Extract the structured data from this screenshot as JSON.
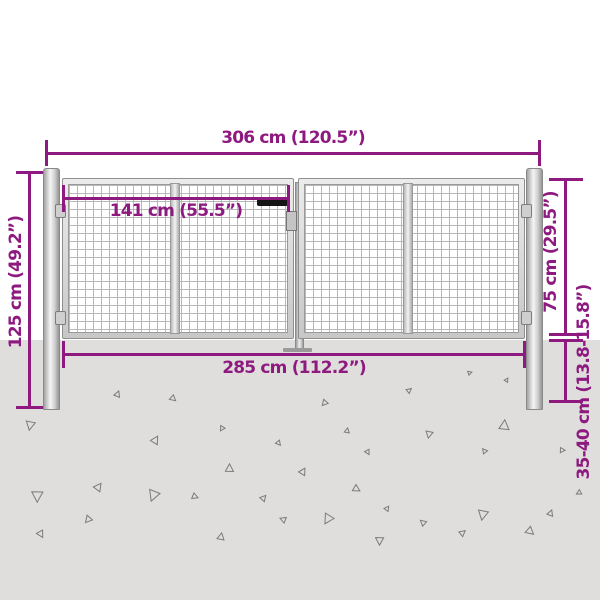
{
  "diagram": {
    "title": "garden-gate-dimension-diagram",
    "dimensions": {
      "total_width": "306 cm (120.5”)",
      "leaf_width": "141 cm (55.5”)",
      "inner_width": "285 cm (112.2”)",
      "post_height": "125 cm (49.2”)",
      "gate_height": "75 cm (29.5”)",
      "ground_depth": "35-40 cm (13.8-15.8”)"
    },
    "colors": {
      "dimension_accent": "#8E1A80",
      "ground": "#DFDEDC",
      "metal_light": "#F5F5F5",
      "metal_dark": "#969696",
      "mesh_line": "#B8B8B8",
      "triangle_stroke": "#7B7B7B",
      "background": "#FFFFFF",
      "handle": "#151515"
    },
    "ground_triangles": [
      [
        25,
        421,
        9,
        200
      ],
      [
        115,
        391,
        6,
        30
      ],
      [
        170,
        396,
        6,
        140
      ],
      [
        152,
        436,
        8,
        40
      ],
      [
        219,
        426,
        5,
        220
      ],
      [
        226,
        464,
        8,
        10
      ],
      [
        276,
        441,
        5,
        150
      ],
      [
        300,
        468,
        7,
        40
      ],
      [
        321,
        400,
        6,
        230
      ],
      [
        345,
        428,
        5,
        20
      ],
      [
        365,
        450,
        5,
        160
      ],
      [
        407,
        388,
        5,
        60
      ],
      [
        425,
        431,
        7,
        200
      ],
      [
        482,
        448,
        5,
        330
      ],
      [
        500,
        420,
        10,
        15
      ],
      [
        31,
        491,
        11,
        190
      ],
      [
        95,
        483,
        8,
        45
      ],
      [
        147,
        490,
        11,
        210
      ],
      [
        192,
        494,
        6,
        120
      ],
      [
        261,
        495,
        6,
        50
      ],
      [
        84,
        516,
        7,
        230
      ],
      [
        37,
        531,
        7,
        160
      ],
      [
        218,
        533,
        7,
        20
      ],
      [
        280,
        516,
        6,
        300
      ],
      [
        322,
        514,
        10,
        220
      ],
      [
        353,
        486,
        7,
        130
      ],
      [
        385,
        506,
        5,
        45
      ],
      [
        375,
        537,
        8,
        190
      ],
      [
        420,
        519,
        6,
        320
      ],
      [
        477,
        510,
        10,
        200
      ],
      [
        460,
        530,
        6,
        60
      ],
      [
        526,
        528,
        8,
        140
      ],
      [
        576,
        490,
        5,
        250
      ],
      [
        548,
        510,
        6,
        30
      ],
      [
        505,
        378,
        4,
        40
      ],
      [
        583,
        443,
        5,
        210
      ],
      [
        560,
        448,
        5,
        100
      ],
      [
        468,
        371,
        4,
        80
      ]
    ]
  }
}
